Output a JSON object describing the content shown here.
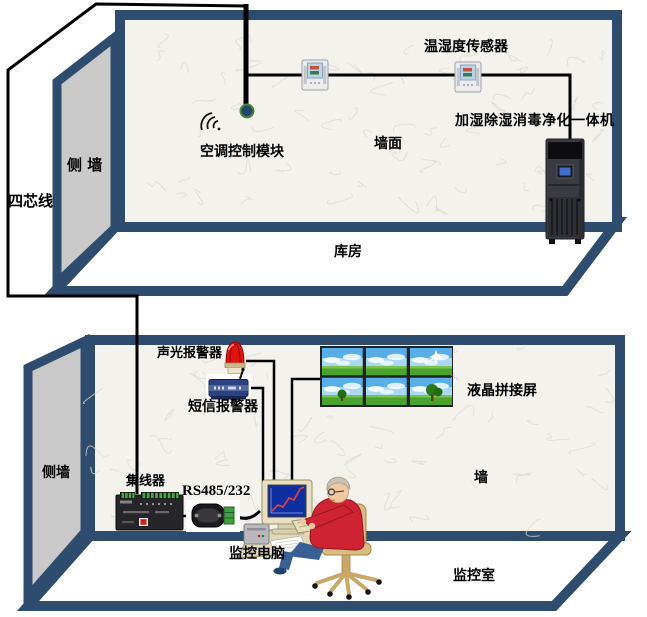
{
  "palette": {
    "navy_border": "#2e4d6e",
    "wall_fill": "#f3f2ed",
    "side_wall_gray": "#c9c9c9",
    "floor_white": "#ffffff",
    "wire_black": "#000000",
    "alarm_red": "#e31212",
    "screen_blue": "#0f2fa0",
    "grass_green": "#4aa32d",
    "sky_blue": "#57aee8",
    "person_red": "#cf2333",
    "chair_tan": "#d9bc82"
  },
  "cable": {
    "label": "四芯线"
  },
  "top_room": {
    "room_label": "库房",
    "side_wall_label": "侧  墙",
    "wall_label": "墙面",
    "sensor_label": "温湿度传感器",
    "ac_module_label": "空调控制模块",
    "purifier_label": "加湿除湿消毒净化一体机"
  },
  "bottom_room": {
    "room_label": "监控室",
    "side_wall_label": "侧墙",
    "wall_label": "墙",
    "alarm_label": "声光报警器",
    "sms_label": "短信报警器",
    "video_wall_label": "液晶拼接屏",
    "hub_label": "集线器",
    "serial_label": "RS485/232",
    "computer_label": "监控电脑"
  }
}
